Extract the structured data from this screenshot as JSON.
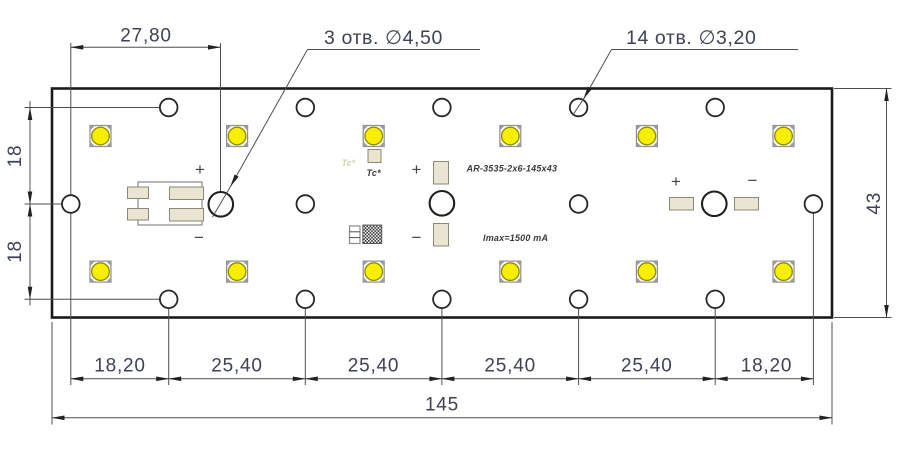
{
  "drawing": {
    "dim_top_width": "27,80",
    "callout_large_holes": "3 отв.  ∅4,50",
    "callout_small_holes": "14 отв.  ∅3,20",
    "dim_left_upper": "18",
    "dim_left_lower": "18",
    "dim_board_height": "43",
    "bottom_chain": [
      "18,20",
      "25,40",
      "25,40",
      "25,40",
      "25,40",
      "18,20"
    ],
    "dim_total_width": "145"
  },
  "board": {
    "part_number": "AR-3535-2x6-145x43",
    "imax_label": "Imax=1500 mA",
    "tc_label": "Tc*",
    "tc_silkscreen": "Tc*",
    "polarity": {
      "plus": "+",
      "minus": "−"
    }
  },
  "legend": {
    "led_count": "12",
    "large_hole_count": "3",
    "small_hole_count": "14"
  },
  "colors": {
    "led_yellow": "#f8ee00",
    "led_ring": "#8d8b00",
    "pad_beige": "#e9e5d1",
    "outline_black": "#1b1b1b",
    "dim_text": "#3d4355"
  }
}
